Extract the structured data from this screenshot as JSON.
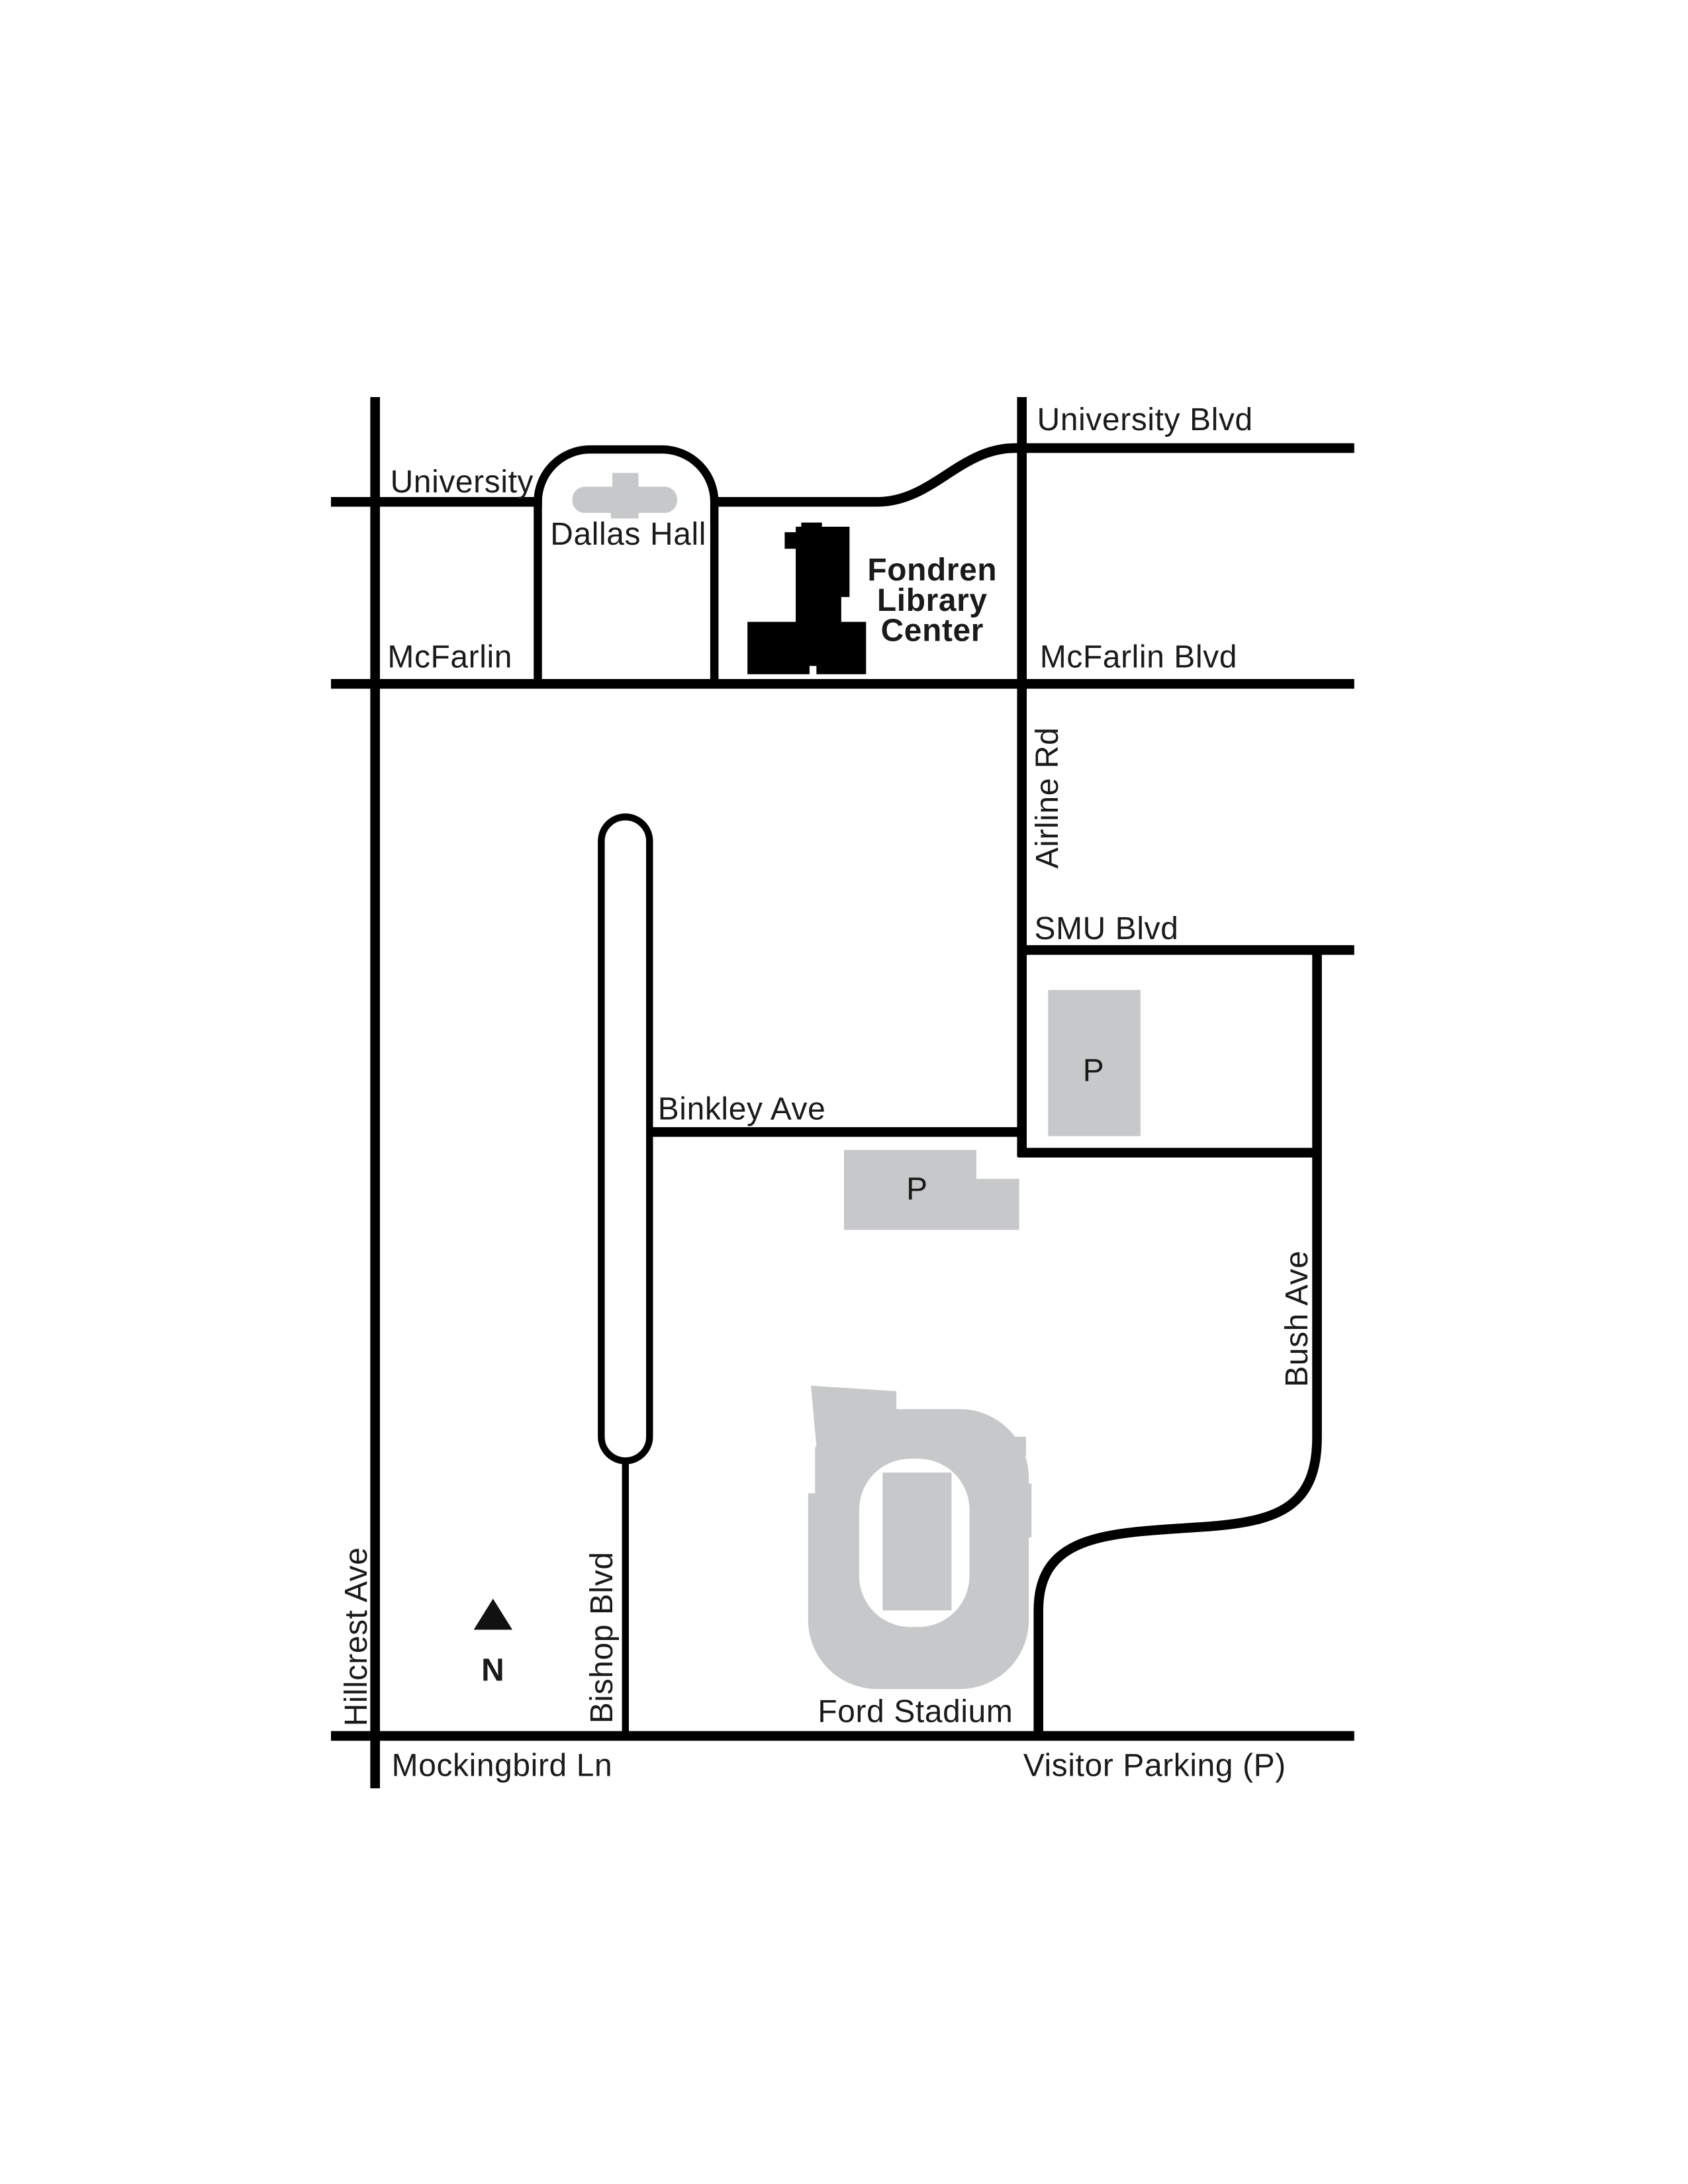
{
  "page": {
    "background": "#ffffff"
  },
  "colors": {
    "road": "#000000",
    "gray_fill": "#c7c8ca",
    "building_black": "#000000",
    "label": "#1a1a1a"
  },
  "streets": {
    "university_blvd": "University Blvd",
    "university": "University",
    "mcfarlin": "McFarlin",
    "mcfarlin_blvd": "McFarlin Blvd",
    "airline_rd": "Airline Rd",
    "smu_blvd": "SMU Blvd",
    "binkley_ave": "Binkley Ave",
    "bush_ave": "Bush Ave",
    "hillcrest_ave": "Hillcrest Ave",
    "bishop_blvd": "Bishop Blvd",
    "mockingbird_ln": "Mockingbird Ln"
  },
  "places": {
    "dallas_hall": "Dallas Hall",
    "fondren_library_center": {
      "line1": "Fondren",
      "line2": "Library",
      "line3": "Center"
    },
    "ford_stadium": "Ford Stadium"
  },
  "parking": {
    "symbol": "P",
    "visitor_note": "Visitor Parking (P)"
  },
  "compass": {
    "north_label": "N"
  }
}
